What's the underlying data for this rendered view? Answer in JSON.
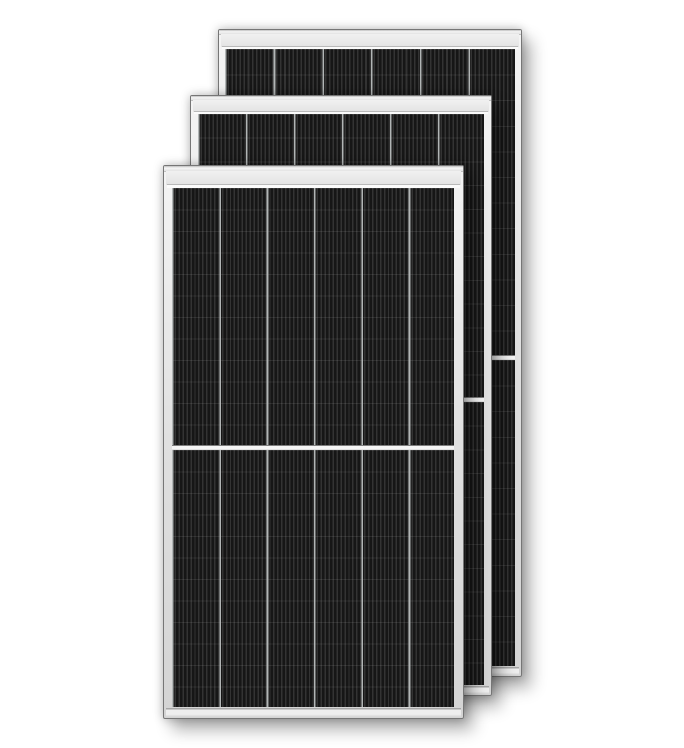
{
  "scene": {
    "description": "Product image of three black monocrystalline half-cut solar panels with silver aluminium frames, overlapping front to back on a white background",
    "panel_count": 3,
    "background_color": "#ffffff"
  },
  "colors": {
    "background": "#ffffff",
    "frame_edge": "#767676",
    "frame_highlight": "#f4f4f4",
    "cell_base": "#1f1f1f",
    "cell_dark": "#161616",
    "cell_light": "#333333",
    "column_divider": "rgba(186,190,190,0.95)",
    "center_gap": "#f5f5f5"
  },
  "panels": [
    {
      "name": "solar-panel-back",
      "left": 218,
      "top": 29,
      "width": 304,
      "height": 648,
      "z": 1,
      "rim_height": 4,
      "bar_height": 13,
      "line_height": 2,
      "cells_left": 6,
      "cells_right": 6,
      "cells_bottom": 10,
      "gap_height": 5,
      "columns": 6,
      "rows_per_half": 12,
      "col_width": 48.7,
      "row_height": 25.6,
      "stripe_period": 4.05
    },
    {
      "name": "solar-panel-middle",
      "left": 190,
      "top": 95,
      "width": 302,
      "height": 601,
      "z": 2,
      "rim_height": 4,
      "bar_height": 12,
      "line_height": 2,
      "cells_left": 7,
      "cells_right": 7,
      "cells_bottom": 10,
      "gap_height": 5,
      "columns": 6,
      "rows_per_half": 12,
      "col_width": 48.0,
      "row_height": 23.7,
      "stripe_period": 4.0
    },
    {
      "name": "solar-panel-front",
      "left": 163,
      "top": 165,
      "width": 301,
      "height": 554,
      "z": 3,
      "rim_height": 5,
      "bar_height": 14,
      "line_height": 3,
      "cells_left": 8,
      "cells_right": 9,
      "cells_bottom": 11,
      "gap_height": 5,
      "columns": 6,
      "rows_per_half": 12,
      "col_width": 47.35,
      "row_height": 21.5,
      "stripe_period": 3.95
    }
  ]
}
